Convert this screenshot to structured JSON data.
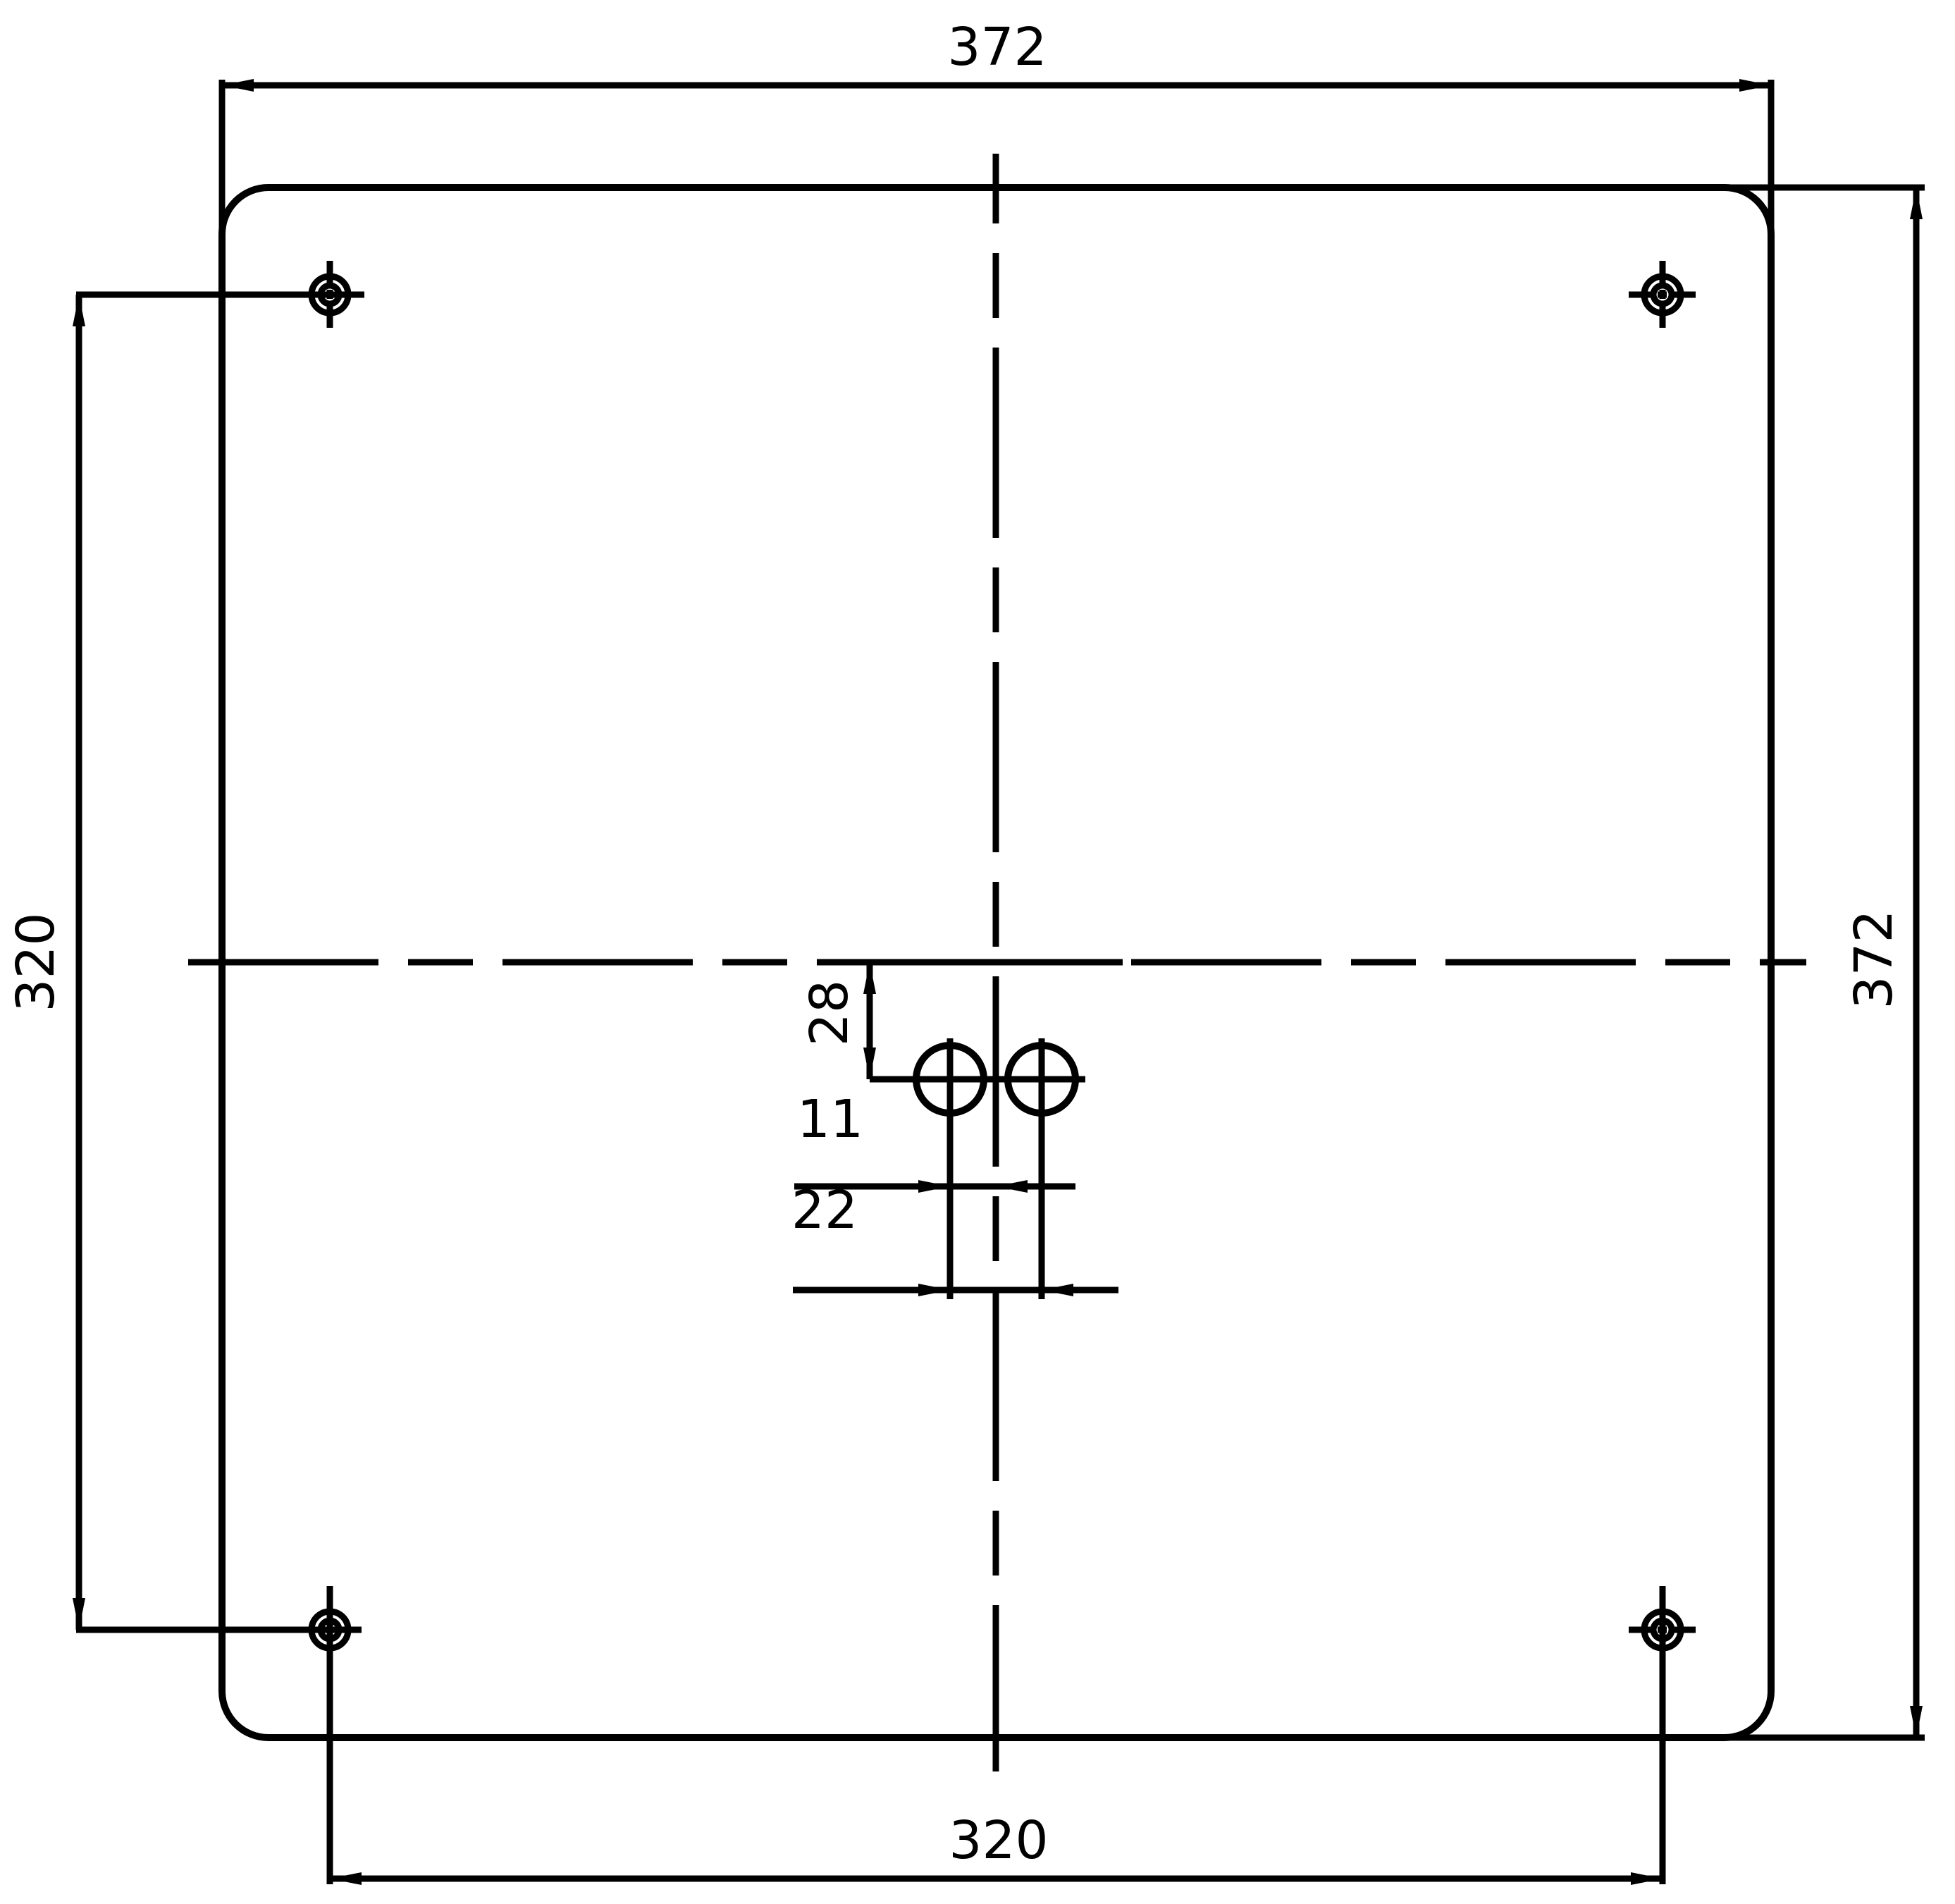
{
  "drawing": {
    "type": "technical-dimension-drawing",
    "units_shown": "none",
    "colors": {
      "line": "#000000",
      "background": "#ffffff"
    },
    "dimensions": {
      "overall_width": "372",
      "overall_height": "372",
      "corner_hole_spacing_vertical": "320",
      "corner_hole_spacing_horizontal": "320",
      "center_hole_offset_from_centerline_vertical": "28",
      "center_hole_to_centerline_horizontal": "11",
      "center_hole_spacing": "22"
    },
    "features": {
      "plate": "square plate with rounded corners",
      "corner_hole_count": "4",
      "center_hole_count": "2"
    }
  }
}
